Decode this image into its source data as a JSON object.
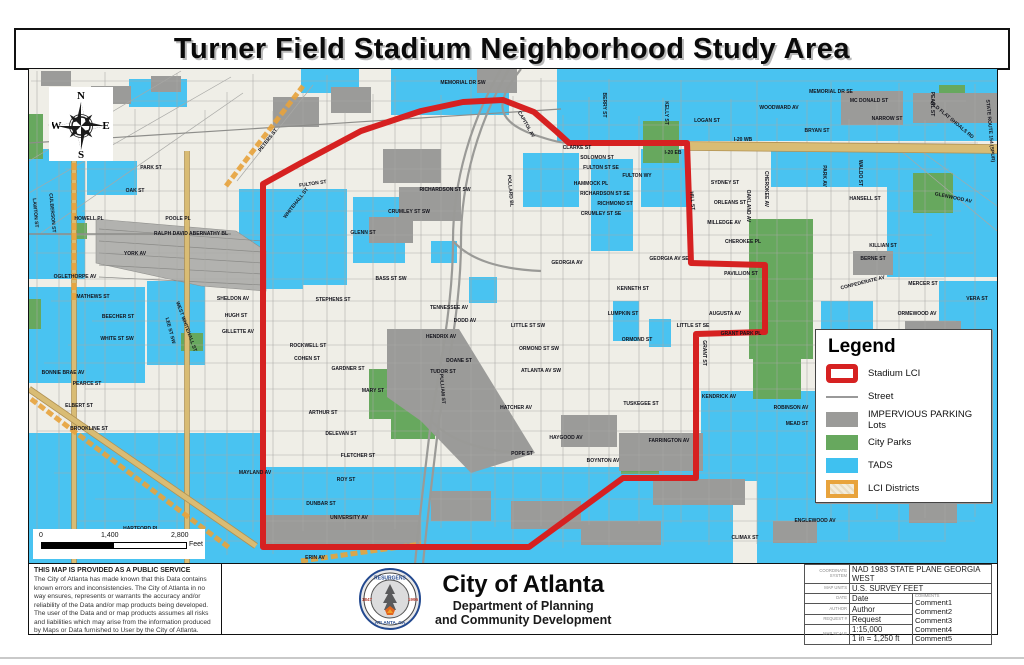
{
  "title": "Turner Field Stadium Neighborhood Study Area",
  "compass": {
    "n": "N",
    "s": "S",
    "e": "E",
    "w": "W"
  },
  "legend": {
    "title": "Legend",
    "items": [
      {
        "swatch": "sw-stadium",
        "label": "Stadium LCI"
      },
      {
        "swatch": "sw-street",
        "label": "Street"
      },
      {
        "swatch": "sw-parking",
        "label": "IMPERVIOUS PARKING Lots"
      },
      {
        "swatch": "sw-parks",
        "label": "City Parks"
      },
      {
        "swatch": "sw-tads",
        "label": "TADS"
      },
      {
        "swatch": "sw-lci",
        "label": "LCI Districts"
      }
    ]
  },
  "scalebar": {
    "t0": "0",
    "t1": "1,400",
    "t2": "2,800",
    "unit": "Feet"
  },
  "disclaimer": {
    "heading": "THIS MAP IS PROVIDED AS A PUBLIC SERVICE",
    "body": "The City of Atlanta has made known that this Data contains known errors and inconsistencies. The City of Atlanta in no way ensures, represents or warrants the accuracy and/or reliability of the Data and/or map products being developed. The user of the Data and or map products assumes all risks and liabilities which may arise from the information produced by Maps or Data furnished to User by the City of Atlanta."
  },
  "agency": {
    "name": "City of Atlanta",
    "dept_line1": "Department of Planning",
    "dept_line2": "and Community Development",
    "seal_top": "RESURGENS",
    "seal_bottom": "ATLANTA, GA",
    "seal_left": "1847",
    "seal_right": "1996"
  },
  "infotable": {
    "rows": [
      {
        "label": "COORDINATE SYSTEM",
        "value": "NAD 1983 STATE PLANE GEORGIA WEST",
        "span": true
      },
      {
        "label": "MAP UNITS",
        "value": "U.S. SURVEY FEET",
        "span": true
      },
      {
        "label": "DATE",
        "value": "Date"
      },
      {
        "label": "AUTHOR",
        "value": "Author"
      },
      {
        "label": "REQUEST #",
        "value": "Request"
      },
      {
        "label": "MAP SCALE",
        "value": "1:15,000",
        "value2": "1 in = 1,250 ft"
      }
    ],
    "comments_label": "COMMENTS",
    "comments": [
      "Comment1",
      "Comment2",
      "Comment3",
      "Comment4",
      "Comment5"
    ]
  },
  "colors": {
    "boundary": "#d62121",
    "tads": "#49c3f1",
    "parks": "#67a85e",
    "parking": "#9b9b99",
    "lci": "#e8a33c",
    "road_tan": "#d9bc74",
    "bg": "#efeee7",
    "grid": "#a8a8a5",
    "rail": "#b2b2af"
  },
  "map": {
    "boundary": [
      262,
      183,
      300,
      162,
      360,
      130,
      420,
      110,
      462,
      101,
      502,
      99,
      533,
      111,
      556,
      131,
      568,
      142,
      686,
      142,
      688,
      200,
      690,
      262,
      764,
      264,
      764,
      331,
      695,
      333,
      695,
      477,
      622,
      477,
      528,
      546,
      262,
      546
    ],
    "tads": [
      [
        556,
        68,
        440,
        72
      ],
      [
        390,
        68,
        118,
        46
      ],
      [
        300,
        68,
        58,
        24
      ],
      [
        128,
        78,
        58,
        28
      ],
      [
        28,
        148,
        56,
        130
      ],
      [
        86,
        160,
        50,
        34
      ],
      [
        28,
        286,
        116,
        96
      ],
      [
        146,
        280,
        58,
        84
      ],
      [
        238,
        188,
        108,
        96
      ],
      [
        352,
        196,
        52,
        66
      ],
      [
        254,
        252,
        48,
        36
      ],
      [
        522,
        152,
        56,
        54
      ],
      [
        590,
        158,
        42,
        92
      ],
      [
        640,
        148,
        46,
        58
      ],
      [
        468,
        276,
        28,
        26
      ],
      [
        430,
        240,
        26,
        22
      ],
      [
        612,
        300,
        26,
        40
      ],
      [
        648,
        318,
        22,
        28
      ],
      [
        770,
        148,
        118,
        38
      ],
      [
        886,
        148,
        110,
        128
      ],
      [
        938,
        280,
        58,
        116
      ],
      [
        820,
        300,
        52,
        32
      ],
      [
        28,
        432,
        232,
        131
      ],
      [
        232,
        466,
        500,
        97
      ],
      [
        700,
        390,
        296,
        90
      ],
      [
        756,
        480,
        240,
        83
      ]
    ],
    "parks": [
      [
        748,
        218,
        64,
        140
      ],
      [
        752,
        358,
        48,
        40
      ],
      [
        642,
        120,
        36,
        42
      ],
      [
        912,
        172,
        40,
        40
      ],
      [
        938,
        84,
        26,
        28
      ],
      [
        368,
        368,
        66,
        50
      ],
      [
        390,
        398,
        44,
        40
      ],
      [
        620,
        447,
        38,
        26
      ],
      [
        72,
        222,
        14,
        16
      ],
      [
        180,
        332,
        22,
        18
      ],
      [
        28,
        113,
        14,
        45
      ],
      [
        28,
        298,
        12,
        30
      ],
      [
        905,
        423,
        52,
        44
      ]
    ],
    "lots": [
      [
        840,
        90,
        62,
        34
      ],
      [
        912,
        92,
        84,
        30
      ],
      [
        382,
        148,
        58,
        34
      ],
      [
        398,
        186,
        62,
        34
      ],
      [
        368,
        216,
        44,
        26
      ],
      [
        262,
        514,
        158,
        32
      ],
      [
        560,
        414,
        56,
        32
      ],
      [
        618,
        432,
        84,
        38
      ],
      [
        652,
        478,
        92,
        26
      ],
      [
        272,
        96,
        46,
        30
      ],
      [
        330,
        86,
        40,
        26
      ],
      [
        476,
        68,
        40,
        24
      ],
      [
        904,
        320,
        56,
        30
      ],
      [
        852,
        250,
        40,
        24
      ],
      [
        820,
        430,
        46,
        26
      ],
      [
        876,
        450,
        56,
        28
      ],
      [
        908,
        500,
        48,
        22
      ],
      [
        772,
        520,
        44,
        22
      ],
      [
        430,
        490,
        60,
        30
      ],
      [
        510,
        500,
        70,
        28
      ],
      [
        580,
        520,
        80,
        24
      ],
      [
        40,
        70,
        30,
        15
      ],
      [
        90,
        85,
        40,
        18
      ],
      [
        150,
        75,
        30,
        16
      ]
    ],
    "lot_polys": [
      [
        386,
        328,
        458,
        328,
        534,
        452,
        470,
        472,
        420,
        420,
        386,
        396
      ]
    ],
    "rail": [
      95,
      218,
      235,
      230,
      265,
      250,
      265,
      290,
      200,
      285,
      95,
      262
    ],
    "diagonals": [
      [
        28,
        160,
        180,
        70
      ],
      [
        28,
        192,
        230,
        76
      ],
      [
        40,
        232,
        242,
        92
      ],
      [
        236,
        180,
        312,
        84
      ],
      [
        900,
        150,
        996,
        230
      ],
      [
        920,
        150,
        996,
        205
      ]
    ],
    "tan_roads": [
      [
        73,
        150,
        73,
        562,
        4
      ],
      [
        186,
        150,
        186,
        562,
        4
      ],
      [
        686,
        145,
        996,
        148,
        8
      ],
      [
        28,
        388,
        255,
        545,
        5
      ]
    ],
    "lci_lines": [
      [
        225,
        185,
        302,
        85
      ],
      [
        73,
        92,
        73,
        300
      ],
      [
        30,
        398,
        230,
        548
      ],
      [
        300,
        560,
        420,
        543
      ]
    ],
    "connector": [
      "M500,68 C470,120 452,180 452,240 C452,300 440,360 430,420 C424,470 418,520 414,563",
      "M508,68 C478,120 460,180 460,240 C460,300 448,360 438,420 C432,470 426,520 422,563",
      "M520,68 C498,96 486,120 540,136 C552,140 560,142 568,142",
      "M452,240 C470,260 500,268 540,270",
      "M430,420 C450,440 480,450 520,452"
    ],
    "major_lines": [
      [
        28,
        233,
        230,
        233,
        1.6
      ],
      [
        28,
        142,
        560,
        108,
        1.2
      ]
    ],
    "labels": [
      {
        "t": "MEMORIAL DR SW",
        "x": 462,
        "y": 83
      },
      {
        "t": "MEMORIAL DR SE",
        "x": 830,
        "y": 92
      },
      {
        "t": "MC DONALD ST",
        "x": 868,
        "y": 101
      },
      {
        "t": "WOODWARD AV",
        "x": 778,
        "y": 108
      },
      {
        "t": "NARROW ST",
        "x": 886,
        "y": 119
      },
      {
        "t": "BRYAN ST",
        "x": 816,
        "y": 131
      },
      {
        "t": "LOGAN ST",
        "x": 706,
        "y": 121
      },
      {
        "t": "I-20 WB",
        "x": 742,
        "y": 140
      },
      {
        "t": "I-20 EB",
        "x": 672,
        "y": 153
      },
      {
        "t": "OLD FLAT SHOALS RD",
        "x": 950,
        "y": 120,
        "r": 40
      },
      {
        "t": "GLENWOOD AV",
        "x": 952,
        "y": 198,
        "r": 12
      },
      {
        "t": "HANSELL ST",
        "x": 864,
        "y": 199
      },
      {
        "t": "PEARL ST",
        "x": 930,
        "y": 103,
        "r": 90
      },
      {
        "t": "CHEROKEE AV",
        "x": 764,
        "y": 188,
        "r": 90
      },
      {
        "t": "PARK AV",
        "x": 822,
        "y": 175,
        "r": 90
      },
      {
        "t": "WALDO ST",
        "x": 858,
        "y": 172,
        "r": 90
      },
      {
        "t": "STATE ROUTE 154 (SPUR)",
        "x": 988,
        "y": 130,
        "r": 85
      },
      {
        "t": "CLARKE ST",
        "x": 576,
        "y": 148
      },
      {
        "t": "FULTON ST SE",
        "x": 600,
        "y": 168
      },
      {
        "t": "SOLOMON ST",
        "x": 596,
        "y": 158
      },
      {
        "t": "FULTON WY",
        "x": 636,
        "y": 176
      },
      {
        "t": "HAMMOCK PL",
        "x": 590,
        "y": 184
      },
      {
        "t": "RICHARDSON ST SE",
        "x": 604,
        "y": 194
      },
      {
        "t": "RICHMOND ST",
        "x": 614,
        "y": 204
      },
      {
        "t": "CRUMLEY ST SE",
        "x": 600,
        "y": 214
      },
      {
        "t": "SYDNEY ST",
        "x": 724,
        "y": 183
      },
      {
        "t": "ORLEANS ST",
        "x": 729,
        "y": 203
      },
      {
        "t": "MILLEDGE AV",
        "x": 723,
        "y": 223
      },
      {
        "t": "CHEROKEE PL",
        "x": 742,
        "y": 242
      },
      {
        "t": "OAKLAND AV",
        "x": 746,
        "y": 205,
        "r": 90
      },
      {
        "t": "KELLY ST",
        "x": 664,
        "y": 112,
        "r": 90
      },
      {
        "t": "BERRY ST",
        "x": 602,
        "y": 104,
        "r": 90
      },
      {
        "t": "CAPITOL AV",
        "x": 524,
        "y": 124,
        "r": 60
      },
      {
        "t": "POLLARD BL",
        "x": 508,
        "y": 190,
        "r": 85
      },
      {
        "t": "KILLIAN ST",
        "x": 882,
        "y": 246
      },
      {
        "t": "BERNE ST",
        "x": 872,
        "y": 259
      },
      {
        "t": "MERCER ST",
        "x": 922,
        "y": 284
      },
      {
        "t": "CONFEDERATE AV",
        "x": 862,
        "y": 283,
        "r": -14
      },
      {
        "t": "ORMEWOOD AV",
        "x": 916,
        "y": 314
      },
      {
        "t": "VERA ST",
        "x": 976,
        "y": 299
      },
      {
        "t": "PAVILLION ST",
        "x": 740,
        "y": 274
      },
      {
        "t": "AUGUSTA AV",
        "x": 724,
        "y": 314
      },
      {
        "t": "GRANT PARK PL",
        "x": 740,
        "y": 334
      },
      {
        "t": "LITTLE ST SE",
        "x": 692,
        "y": 326
      },
      {
        "t": "HILL ST",
        "x": 690,
        "y": 200,
        "r": 85
      },
      {
        "t": "GRANT ST",
        "x": 702,
        "y": 352,
        "r": 90
      },
      {
        "t": "GEORGIA AV",
        "x": 566,
        "y": 263
      },
      {
        "t": "GEORGIA AV SE",
        "x": 668,
        "y": 259
      },
      {
        "t": "KENNETH ST",
        "x": 632,
        "y": 289
      },
      {
        "t": "LUMPKIN ST",
        "x": 622,
        "y": 314
      },
      {
        "t": "ORMOND ST",
        "x": 636,
        "y": 340
      },
      {
        "t": "WHITEHALL ST",
        "x": 296,
        "y": 203,
        "r": -52
      },
      {
        "t": "PETERS ST",
        "x": 268,
        "y": 140,
        "r": -52
      },
      {
        "t": "FULTON ST",
        "x": 312,
        "y": 184,
        "r": -8
      },
      {
        "t": "GLENN ST",
        "x": 362,
        "y": 233
      },
      {
        "t": "CRUMLEY ST SW",
        "x": 408,
        "y": 212
      },
      {
        "t": "RICHARDSON ST SW",
        "x": 444,
        "y": 190
      },
      {
        "t": "BASS ST SW",
        "x": 390,
        "y": 279
      },
      {
        "t": "STEPHENS ST",
        "x": 332,
        "y": 300
      },
      {
        "t": "TENNESSEE AV",
        "x": 448,
        "y": 308
      },
      {
        "t": "DODD AV",
        "x": 464,
        "y": 321
      },
      {
        "t": "HENDRIX AV",
        "x": 440,
        "y": 337
      },
      {
        "t": "DOANE ST",
        "x": 458,
        "y": 361
      },
      {
        "t": "TUDOR ST",
        "x": 442,
        "y": 372
      },
      {
        "t": "MARY ST",
        "x": 372,
        "y": 391
      },
      {
        "t": "ROCKWELL ST",
        "x": 307,
        "y": 346
      },
      {
        "t": "COHEN ST",
        "x": 306,
        "y": 359
      },
      {
        "t": "GARDNER ST",
        "x": 347,
        "y": 369
      },
      {
        "t": "ARTHUR ST",
        "x": 322,
        "y": 413
      },
      {
        "t": "DELEVAN ST",
        "x": 340,
        "y": 434
      },
      {
        "t": "FLETCHER ST",
        "x": 357,
        "y": 456
      },
      {
        "t": "ROY ST",
        "x": 345,
        "y": 480
      },
      {
        "t": "DUNBAR ST",
        "x": 320,
        "y": 504
      },
      {
        "t": "UNIVERSITY AV",
        "x": 348,
        "y": 518
      },
      {
        "t": "MAYLAND AV",
        "x": 254,
        "y": 473
      },
      {
        "t": "HARTFORD PL",
        "x": 140,
        "y": 529
      },
      {
        "t": "RALPH DAVID ABERNATHY BL",
        "x": 190,
        "y": 234
      },
      {
        "t": "OAK ST",
        "x": 134,
        "y": 191
      },
      {
        "t": "PARK ST",
        "x": 150,
        "y": 168
      },
      {
        "t": "YORK AV",
        "x": 134,
        "y": 254
      },
      {
        "t": "OGLETHORPE AV",
        "x": 74,
        "y": 277
      },
      {
        "t": "MATHEWS ST",
        "x": 92,
        "y": 297
      },
      {
        "t": "BEECHER ST",
        "x": 117,
        "y": 317
      },
      {
        "t": "WHITE ST SW",
        "x": 116,
        "y": 339
      },
      {
        "t": "HOWELL PL",
        "x": 88,
        "y": 219
      },
      {
        "t": "POOLE PL",
        "x": 177,
        "y": 219
      },
      {
        "t": "LAWTON ST",
        "x": 33,
        "y": 212,
        "r": 85
      },
      {
        "t": "CULBERSON ST",
        "x": 50,
        "y": 212,
        "r": 85
      },
      {
        "t": "LEE ST SW",
        "x": 168,
        "y": 330,
        "r": 75
      },
      {
        "t": "WEST WHITEHALL ST",
        "x": 184,
        "y": 326,
        "r": 70
      },
      {
        "t": "SHELDON AV",
        "x": 232,
        "y": 299
      },
      {
        "t": "HUGH ST",
        "x": 235,
        "y": 316
      },
      {
        "t": "GILLETTE AV",
        "x": 237,
        "y": 332
      },
      {
        "t": "BONNIE BRAE AV",
        "x": 62,
        "y": 373
      },
      {
        "t": "PEARCE ST",
        "x": 86,
        "y": 384
      },
      {
        "t": "ELBERT ST",
        "x": 78,
        "y": 406
      },
      {
        "t": "BROOKLINE ST",
        "x": 88,
        "y": 429
      },
      {
        "t": "KENDRICK AV",
        "x": 718,
        "y": 397
      },
      {
        "t": "ROBINSON AV",
        "x": 790,
        "y": 408
      },
      {
        "t": "MEAD ST",
        "x": 796,
        "y": 424
      },
      {
        "t": "TUSKEGEE ST",
        "x": 640,
        "y": 404
      },
      {
        "t": "FARRINGTON AV",
        "x": 668,
        "y": 441
      },
      {
        "t": "HAYGOOD AV",
        "x": 565,
        "y": 438
      },
      {
        "t": "BOYNTON AV",
        "x": 602,
        "y": 461
      },
      {
        "t": "POPE ST",
        "x": 521,
        "y": 454
      },
      {
        "t": "ATLANTA AV SW",
        "x": 540,
        "y": 371
      },
      {
        "t": "ORMOND ST SW",
        "x": 538,
        "y": 349
      },
      {
        "t": "LITTLE ST SW",
        "x": 527,
        "y": 326
      },
      {
        "t": "HATCHER AV",
        "x": 515,
        "y": 408
      },
      {
        "t": "PULLIAM ST",
        "x": 440,
        "y": 388,
        "r": 85
      },
      {
        "t": "ENGLEWOOD AV",
        "x": 814,
        "y": 521
      },
      {
        "t": "CLIMAX ST",
        "x": 744,
        "y": 538
      },
      {
        "t": "ERIN AV",
        "x": 314,
        "y": 558
      }
    ]
  }
}
